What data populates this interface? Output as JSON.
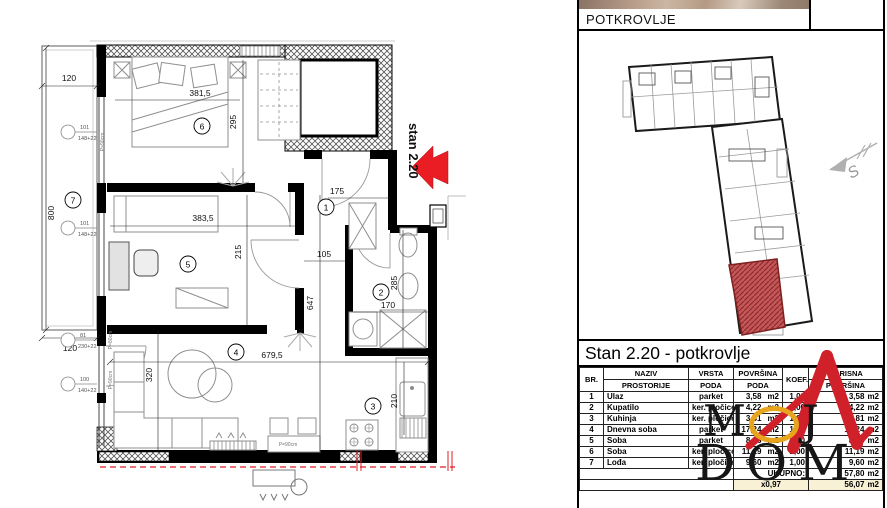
{
  "colors": {
    "accent_red": "#e01c24",
    "logo_red": "#d0202a",
    "logo_yellow": "#e7a51d",
    "highlight_cream": "#f8f1d6",
    "red_unit_fill": "#c4575a"
  },
  "plan": {
    "unit_label": "stan 2.20",
    "room_numbers": [
      "1",
      "2",
      "3",
      "4",
      "5",
      "6",
      "7"
    ],
    "dims": {
      "loggia_width_top": "120",
      "loggia_length": "800",
      "bedroom_width": "381,5",
      "bedroom_depth": "295",
      "room5_width": "383,5",
      "hall_depth": "215",
      "entry_width": "175",
      "hall_width": "105",
      "east_depth": "647",
      "bath_depth": "285",
      "bath_width": "170",
      "living_width": "679,5",
      "living_depth": "320",
      "kitchen_depth": "210",
      "loggia_width_bottom": "120"
    },
    "window_tags": [
      {
        "code": "101",
        "size": "148+22"
      },
      {
        "code": "101",
        "size": "148+22"
      },
      {
        "code": "81",
        "size": "230+22"
      },
      {
        "code": "100",
        "size": "140+22"
      }
    ],
    "door_labels": [
      "P=90cm",
      "P=80cm",
      "P=90cm",
      "P=90cm"
    ]
  },
  "right_panel": {
    "floor_title": "POTKROVLJE",
    "north_label": "S",
    "unit_heading": "Stan 2.20 - potkrovlje",
    "table": {
      "unit": "m2",
      "headers": {
        "br": "BR.",
        "naziv_l1": "NAZIV",
        "naziv_l2": "PROSTORIJE",
        "vrsta_l1": "VRSTA",
        "vrsta_l2": "PODA",
        "povrsina_l1": "POVRŠINA",
        "povrsina_l2": "PODA",
        "koef": "KOEF.",
        "korisna_l1": "KORISNA",
        "korisna_l2": "POVRŠINA"
      },
      "rows": [
        {
          "br": "1",
          "naziv": "Ulaz",
          "vrsta": "parket",
          "povrsina": "3,58",
          "koef": "1,00",
          "korisna": "3,58"
        },
        {
          "br": "2",
          "naziv": "Kupatilo",
          "vrsta": "ker. pločice",
          "povrsina": "4,22",
          "koef": "1,00",
          "korisna": "4,22"
        },
        {
          "br": "3",
          "naziv": "Kuhinja",
          "vrsta": "ker. pločice",
          "povrsina": "3,81",
          "koef": "1,00",
          "korisna": "3,81"
        },
        {
          "br": "4",
          "naziv": "Dnevna soba",
          "vrsta": "parket",
          "povrsina": "17,24",
          "koef": "1,00",
          "korisna": "17,24"
        },
        {
          "br": "5",
          "naziv": "Soba",
          "vrsta": "parket",
          "povrsina": "8,16",
          "koef": "1,00",
          "korisna": "8,16"
        },
        {
          "br": "6",
          "naziv": "Soba",
          "vrsta": "ker. pločice",
          "povrsina": "11,19",
          "koef": "1,00",
          "korisna": "11,19"
        },
        {
          "br": "7",
          "naziv": "Lođa",
          "vrsta": "ker. pločice",
          "povrsina": "9,60",
          "koef": "1,00",
          "korisna": "9,60"
        }
      ],
      "total_label": "UKUPNO:",
      "total_value": "57,80",
      "reduction_label": "x0,97",
      "reduced_value": "56,07"
    },
    "logo": {
      "m": "M",
      "j": "J",
      "word2": "DOM"
    }
  }
}
